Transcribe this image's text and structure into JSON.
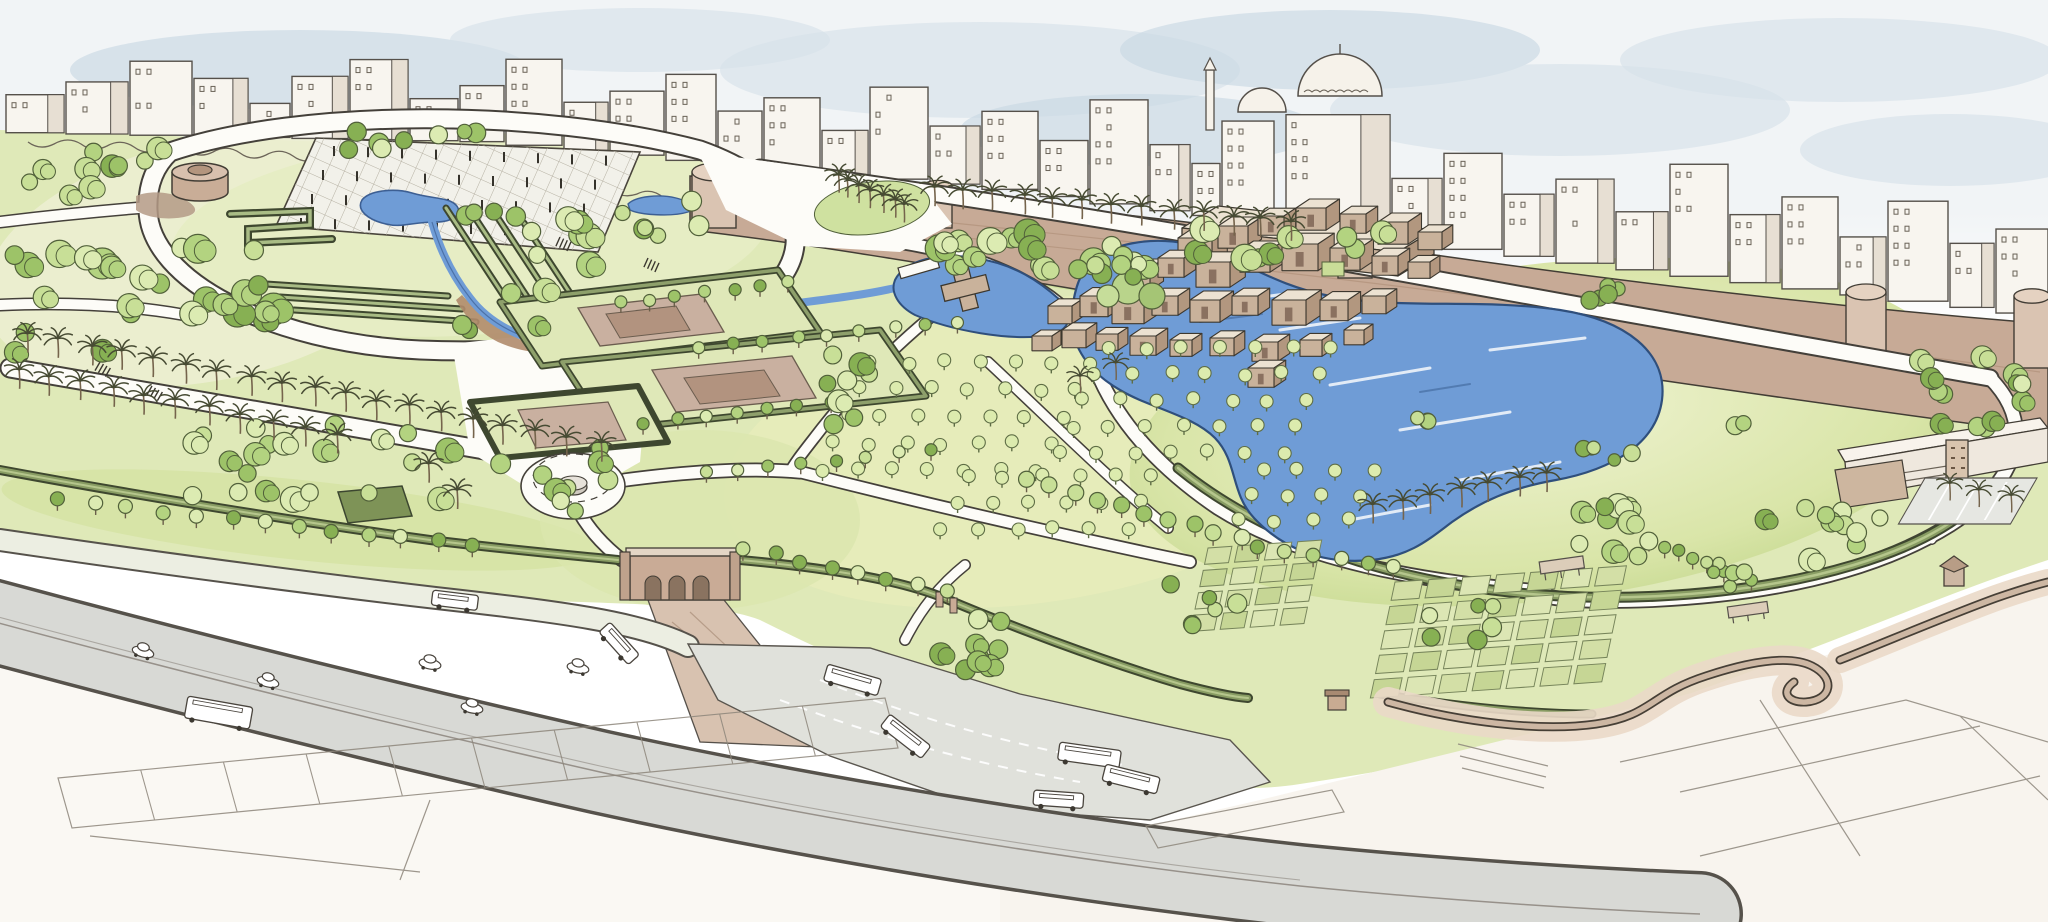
{
  "meta": {
    "kind": "hand-drawn aerial masterplan illustration",
    "subject": "watercolor sketch of a large urban park beside a historic walled city",
    "width": 2048,
    "height": 922
  },
  "palette": {
    "paper": "#ffffff",
    "sky": "#f1f4f6",
    "cloud": "#d7e2ea",
    "cloud2": "#c9d8e3",
    "line": "#423d35",
    "sketch": "#8d867b",
    "scribble": "#6c6559",
    "wall": "#c7aa96",
    "wallLight": "#dac4b2",
    "water": "#6f9cd6",
    "waterEdge": "#3d5f93",
    "grass": "#dfe9b8",
    "grassPale": "#eceed2",
    "grassMid": "#d4e2a2",
    "grassFresh": "#cde09c",
    "lawnLight": "#eef2cf",
    "lawnDeep": "#c3d78d",
    "hedgeDark": "#3e472f",
    "hedgeMid": "#889c63",
    "hedgeLight": "#b5c68c",
    "treeOutline": "#51603a",
    "greens": [
      "#dcebb2",
      "#c8df97",
      "#b3d380",
      "#9dc368",
      "#87b053"
    ],
    "orchardTree": "#dcebae",
    "roadFill": "#d8d9d5",
    "roadEdge": "#56524b",
    "pathWhite": "#fdfcf8",
    "tanBuilding": "#c9b29b",
    "tanSide": "#b2977f",
    "tanRoof": "#ece2d2",
    "tanDoor": "#8a7160",
    "rampTan": "#d8c2b0",
    "serpentine": "#cdb7a3",
    "parterreTan": "#c9b0a0",
    "parterreDeep": "#b2937f",
    "buildingFace": "#f8f5ef",
    "buildingShade": "#e7dfd3"
  },
  "scene": {
    "features": [
      "city-skyline",
      "historic-city-wall",
      "wall-towers",
      "mosque-domes",
      "minaret",
      "round-cistern-tower",
      "trellis-garden-plaza",
      "plaza-pond",
      "stream-cascade",
      "terraced-planters",
      "zigzag-hedge",
      "formal-walled-gardens",
      "garden-fountain",
      "museum-building-cluster",
      "cross-pavilion",
      "boat-pier",
      "kidney-lake",
      "palm-promenade",
      "palm-grove-island",
      "orchard-grids",
      "allotment-parterres",
      "great-lawn",
      "lawn-hedge-rim",
      "entry-gate-arches",
      "gate-ramp",
      "plaza-fountain-circle",
      "serpentine-wall-walk",
      "wall-pavilion",
      "pergolas",
      "kiosk",
      "visitor-building",
      "parking-lot",
      "highway",
      "access-road",
      "bus-dropoff",
      "buses",
      "cars",
      "city-block-sketch"
    ],
    "horizon": [
      [
        0,
        132
      ],
      [
        500,
        142
      ],
      [
        760,
        167
      ],
      [
        1000,
        188
      ],
      [
        1300,
        228
      ],
      [
        1600,
        265
      ],
      [
        2048,
        316
      ]
    ],
    "clouds": [
      [
        300,
        70,
        230,
        40
      ],
      [
        640,
        40,
        190,
        32
      ],
      [
        980,
        70,
        260,
        48
      ],
      [
        1330,
        50,
        210,
        40
      ],
      [
        1560,
        110,
        230,
        46
      ],
      [
        1840,
        60,
        220,
        42
      ],
      [
        1140,
        130,
        180,
        36
      ],
      [
        480,
        130,
        160,
        30
      ],
      [
        1950,
        150,
        150,
        36
      ]
    ],
    "skyline": {
      "buildings": [
        [
          6,
          58,
          38
        ],
        [
          66,
          62,
          52
        ],
        [
          130,
          62,
          74
        ],
        [
          194,
          54,
          58
        ],
        [
          250,
          40,
          34
        ],
        [
          292,
          56,
          62
        ],
        [
          350,
          58,
          80
        ],
        [
          410,
          48,
          42
        ],
        [
          460,
          44,
          56
        ],
        [
          506,
          56,
          86
        ],
        [
          564,
          44,
          48
        ],
        [
          610,
          54,
          64
        ],
        [
          666,
          50,
          86
        ],
        [
          718,
          44,
          54
        ],
        [
          764,
          56,
          72
        ],
        [
          822,
          46,
          44
        ],
        [
          870,
          58,
          92
        ],
        [
          930,
          50,
          58
        ],
        [
          982,
          56,
          78
        ],
        [
          1040,
          48,
          56
        ],
        [
          1090,
          58,
          104
        ],
        [
          1150,
          40,
          66
        ],
        [
          1192,
          28,
          52
        ],
        [
          1222,
          52,
          100
        ],
        [
          1286,
          104,
          118
        ],
        [
          1392,
          50,
          64
        ],
        [
          1444,
          58,
          96
        ],
        [
          1504,
          50,
          62
        ],
        [
          1556,
          58,
          84
        ],
        [
          1616,
          52,
          58
        ],
        [
          1670,
          58,
          112
        ],
        [
          1730,
          50,
          68
        ],
        [
          1782,
          56,
          92
        ],
        [
          1840,
          46,
          58
        ],
        [
          1888,
          60,
          100
        ],
        [
          1950,
          44,
          64
        ],
        [
          1996,
          52,
          84
        ]
      ]
    },
    "wallTowers": [
      [
        692,
        172,
        44,
        56
      ],
      [
        924,
        186,
        28,
        42
      ],
      [
        1338,
        226,
        34,
        52
      ],
      [
        1846,
        292,
        40,
        62
      ],
      [
        2014,
        296,
        36,
        72
      ]
    ],
    "trellisPoles": {
      "x": 334,
      "y": 156,
      "cols": 9,
      "rows": 4,
      "dx": 34,
      "dy": 24,
      "skx": -11,
      "drift": 1.2
    },
    "terraceBarsB": {
      "x1": 266,
      "y1": 284,
      "x2": 448,
      "y2": 296,
      "count": 3,
      "stepX": 14,
      "stepY": 13
    },
    "terraceBarsC": {
      "x1": 446,
      "y1": 208,
      "x2": 513,
      "y2": 310,
      "count": 4,
      "stepX": 26,
      "stepY": 5
    },
    "hatches": [
      [
        560,
        237,
        24
      ],
      [
        648,
        258,
        24
      ],
      [
        100,
        362,
        30
      ],
      [
        152,
        386,
        30
      ]
    ],
    "cubes": [
      [
        1178,
        238,
        34
      ],
      [
        1218,
        226,
        30
      ],
      [
        1258,
        216,
        26
      ],
      [
        1296,
        208,
        30
      ],
      [
        1340,
        214,
        26
      ],
      [
        1378,
        222,
        30
      ],
      [
        1418,
        232,
        24
      ],
      [
        1120,
        268,
        30
      ],
      [
        1158,
        258,
        26
      ],
      [
        1196,
        262,
        34
      ],
      [
        1240,
        250,
        30
      ],
      [
        1282,
        244,
        36
      ],
      [
        1330,
        248,
        30
      ],
      [
        1372,
        256,
        26
      ],
      [
        1408,
        262,
        22
      ],
      [
        1048,
        306,
        24
      ],
      [
        1080,
        296,
        28
      ],
      [
        1112,
        300,
        32
      ],
      [
        1152,
        296,
        26
      ],
      [
        1190,
        300,
        30
      ],
      [
        1232,
        296,
        26
      ],
      [
        1272,
        300,
        34
      ],
      [
        1320,
        300,
        28
      ],
      [
        1362,
        296,
        24
      ],
      [
        1032,
        336,
        20
      ],
      [
        1062,
        330,
        24
      ],
      [
        1096,
        334,
        22
      ],
      [
        1130,
        336,
        26
      ],
      [
        1170,
        340,
        22
      ],
      [
        1210,
        338,
        24
      ],
      [
        1252,
        342,
        26
      ],
      [
        1300,
        340,
        22
      ],
      [
        1344,
        330,
        20
      ],
      [
        1248,
        368,
        26
      ]
    ],
    "tree_clusters": [
      [
        150,
        300,
        26,
        140,
        55,
        9,
        16
      ],
      [
        90,
        170,
        10,
        70,
        28,
        8,
        12
      ],
      [
        515,
        275,
        16,
        75,
        65,
        8,
        13
      ],
      [
        350,
        465,
        22,
        160,
        40,
        8,
        13
      ],
      [
        585,
        480,
        8,
        45,
        35,
        8,
        12
      ],
      [
        1160,
        250,
        26,
        230,
        22,
        9,
        14
      ],
      [
        860,
        390,
        8,
        45,
        35,
        8,
        12
      ],
      [
        660,
        215,
        6,
        40,
        22,
        7,
        10
      ],
      [
        1100,
        268,
        5,
        40,
        18,
        7,
        10
      ],
      [
        1602,
        292,
        5,
        28,
        14,
        7,
        10
      ],
      [
        1975,
        390,
        14,
        55,
        38,
        8,
        12
      ],
      [
        1612,
        450,
        5,
        35,
        15,
        6,
        9
      ],
      [
        1600,
        528,
        10,
        55,
        30,
        8,
        13
      ],
      [
        1822,
        528,
        10,
        58,
        32,
        8,
        12
      ],
      [
        965,
        645,
        9,
        40,
        30,
        8,
        12
      ],
      [
        1205,
        600,
        6,
        40,
        28,
        7,
        10
      ],
      [
        1462,
        622,
        6,
        40,
        26,
        7,
        10
      ],
      [
        1720,
        570,
        5,
        28,
        18,
        6,
        9
      ],
      [
        1425,
        428,
        3,
        20,
        10,
        6,
        9
      ],
      [
        1745,
        428,
        2,
        18,
        8,
        7,
        9
      ],
      [
        420,
        142,
        8,
        80,
        12,
        7,
        10
      ]
    ],
    "tree_rows": [
      [
        60,
        500,
        470,
        545,
        13,
        7
      ],
      [
        745,
        548,
        945,
        592,
        8,
        7
      ],
      [
        1025,
        480,
        1240,
        538,
        10,
        8
      ],
      [
        1258,
        546,
        1395,
        566,
        6,
        7
      ],
      [
        620,
        302,
        790,
        282,
        7,
        6
      ],
      [
        700,
        348,
        958,
        322,
        9,
        6
      ],
      [
        645,
        422,
        830,
        402,
        7,
        6
      ],
      [
        705,
        472,
        930,
        450,
        8,
        6
      ],
      [
        1650,
        540,
        1750,
        582,
        8,
        6
      ]
    ],
    "palm_rows": [
      [
        28,
        352,
        600,
        462,
        19,
        1
      ],
      [
        18,
        388,
        336,
        452,
        11,
        1
      ],
      [
        934,
        206,
        1292,
        240,
        13,
        1
      ],
      [
        838,
        192,
        906,
        224,
        7,
        0.95
      ],
      [
        1372,
        524,
        1548,
        492,
        7,
        1
      ],
      [
        428,
        484,
        456,
        508,
        2,
        1
      ],
      [
        1952,
        500,
        2010,
        512,
        3,
        0.9
      ],
      [
        1082,
        392,
        1118,
        380,
        2,
        0.9
      ]
    ],
    "orchards": [
      [
        872,
        372,
        7,
        5,
        36,
        27,
        -13
      ],
      [
        1108,
        358,
        7,
        5,
        37,
        26,
        -12
      ],
      [
        968,
        486,
        6,
        3,
        37,
        26,
        -13
      ],
      [
        1262,
        480,
        4,
        3,
        37,
        25,
        -12
      ]
    ],
    "allotments": [
      [
        1208,
        548,
        4,
        4,
        30,
        22
      ],
      [
        1395,
        582,
        7,
        5,
        34,
        24
      ]
    ],
    "parcelStrip": {
      "top": [
        58,
        778,
        885,
        698
      ],
      "bottom": [
        72,
        828,
        898,
        748
      ],
      "lines": 9
    },
    "water_highlights": [
      [
        1280,
        330,
        1360,
        318
      ],
      [
        1330,
        385,
        1430,
        368
      ],
      [
        1400,
        430,
        1510,
        412
      ],
      [
        1460,
        480,
        1560,
        462
      ],
      [
        1490,
        350,
        1585,
        338
      ],
      [
        1240,
        300,
        1300,
        292
      ],
      [
        1180,
        270,
        1240,
        262
      ],
      [
        1350,
        520,
        1430,
        505
      ]
    ],
    "water_dark": [
      [
        1200,
        322,
        1262,
        314
      ],
      [
        1420,
        392,
        1470,
        384
      ]
    ],
    "vehicles": {
      "buses": [
        [
          188,
          696,
          66,
          22,
          10
        ],
        [
          433,
          590,
          46,
          15,
          7
        ],
        [
          610,
          622,
          44,
          15,
          48
        ],
        [
          828,
          664,
          56,
          17,
          16
        ],
        [
          890,
          714,
          52,
          16,
          38
        ],
        [
          1060,
          742,
          62,
          18,
          8
        ],
        [
          1106,
          764,
          56,
          17,
          14
        ],
        [
          1034,
          790,
          50,
          15,
          4
        ]
      ],
      "cars": [
        [
          143,
          652,
          16
        ],
        [
          268,
          682,
          14
        ],
        [
          430,
          664,
          11
        ],
        [
          472,
          708,
          12
        ],
        [
          578,
          668,
          12
        ]
      ]
    }
  }
}
